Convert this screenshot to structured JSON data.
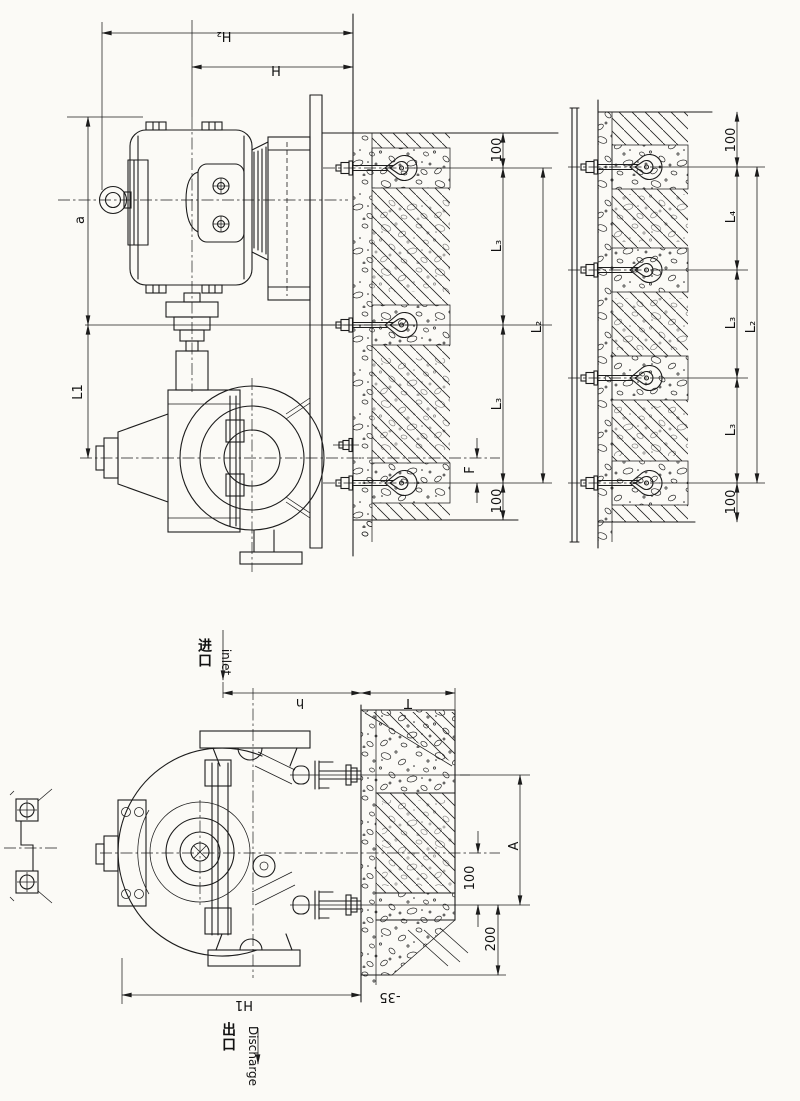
{
  "drawing": {
    "type": "pump wall-mount installation drawing",
    "line_color": "#1c1c1c",
    "paper_color": "#fbfaf6",
    "dims": {
      "H2": "H₂",
      "H": "H",
      "a": "a",
      "L1": "L1",
      "d100": "100",
      "L3": "L₃",
      "L2": "L₂",
      "L4": "L₄",
      "F": "F",
      "h": "h",
      "T": "T",
      "A": "A",
      "d200": "200",
      "H1": "H1",
      "neg35": "-35"
    },
    "labels": {
      "inlet_cn": "进口",
      "inlet_en": "inlet",
      "outlet_cn": "出口",
      "outlet_en": "Discharge"
    }
  }
}
